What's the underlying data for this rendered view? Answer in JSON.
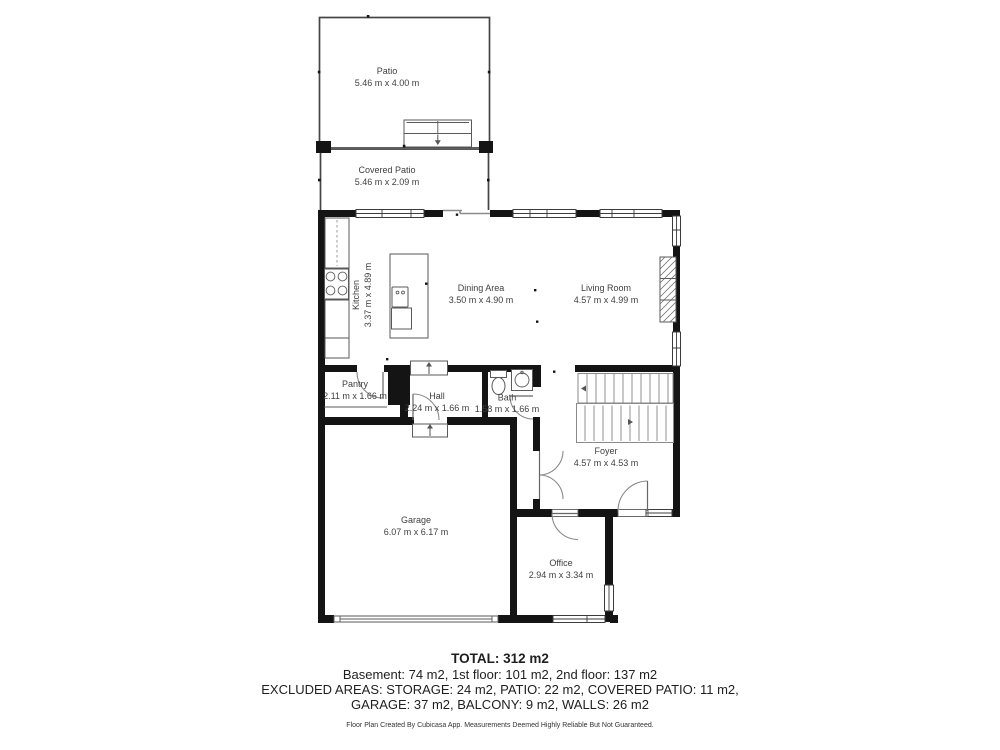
{
  "colors": {
    "wall": "#141414",
    "thin_line": "#454545",
    "label_text": "#3f3f3f",
    "background": "#ffffff"
  },
  "rooms": {
    "patio": {
      "name": "Patio",
      "dims": "5.46 m x 4.00 m"
    },
    "covered_patio": {
      "name": "Covered Patio",
      "dims": "5.46 m x 2.09 m"
    },
    "kitchen": {
      "name": "Kitchen",
      "dims": "3.37 m x 4.89 m"
    },
    "dining": {
      "name": "Dining Area",
      "dims": "3.50 m x 4.90 m"
    },
    "living": {
      "name": "Living Room",
      "dims": "4.57 m x 4.99 m"
    },
    "pantry": {
      "name": "Pantry",
      "dims": "2.11 m x 1.66 m"
    },
    "hall": {
      "name": "Hall",
      "dims": "2.24 m x 1.66 m"
    },
    "bath": {
      "name": "Bath",
      "dims": "1.58 m x 1.66 m"
    },
    "foyer": {
      "name": "Foyer",
      "dims": "4.57 m x 4.53 m"
    },
    "garage": {
      "name": "Garage",
      "dims": "6.07 m x 6.17 m"
    },
    "office": {
      "name": "Office",
      "dims": "2.94 m x 3.34 m"
    }
  },
  "summary": {
    "total": "TOTAL: 312 m2",
    "floors": "Basement: 74 m2, 1st floor: 101 m2, 2nd floor: 137 m2",
    "excluded_1": "EXCLUDED AREAS: STORAGE: 24 m2, PATIO: 22 m2, COVERED PATIO: 11 m2,",
    "excluded_2": "GARAGE: 37 m2, BALCONY: 9 m2, WALLS: 26 m2",
    "disclaimer": "Floor Plan Created By Cubicasa App. Measurements Deemed Highly Reliable But Not Guaranteed."
  }
}
